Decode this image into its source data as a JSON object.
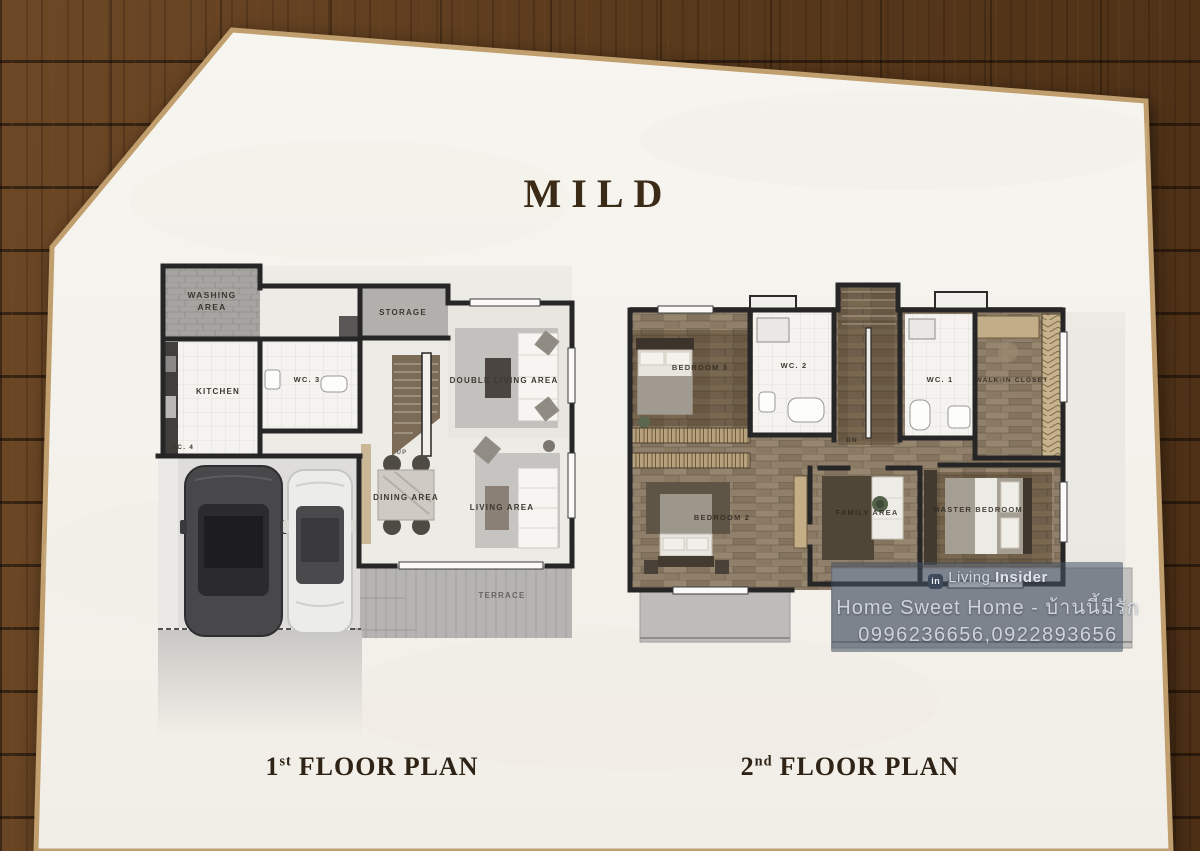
{
  "title": "MILD",
  "captions": {
    "first_num": "1",
    "first_sup": "st",
    "first_text": "FLOOR PLAN",
    "second_num": "2",
    "second_sup": "nd",
    "second_text": "FLOOR PLAN"
  },
  "floor1": {
    "washing1": "WASHING",
    "washing2": "AREA",
    "kitchen": "KITCHEN",
    "wc3": "WC. 3",
    "wc4": "WC. 4",
    "storage": "STORAGE",
    "up": "UP",
    "double_living": "DOUBLE LIVING AREA",
    "dining": "DINING AREA",
    "living": "LIVING AREA",
    "terrace": "TERRACE"
  },
  "floor2": {
    "bedroom3": "BEDROOM 3",
    "wc2": "WC. 2",
    "dn": "DN",
    "wc1": "WC. 1",
    "walkin": "WALK-IN CLOSET",
    "bedroom2": "BEDROOM 2",
    "family": "FAMILY AREA",
    "master": "MASTER BEDROOM"
  },
  "watermark": {
    "brand_prefix": "Living",
    "brand_suffix": "Insider",
    "logo_glyph": "in",
    "tagline": "Home Sweet Home - บ้านนี้มีรัก",
    "phones": "0996236656,0922893656"
  },
  "colors": {
    "wood_background": "#5e3c1d",
    "paper": "#f5f2ec",
    "paper_edge": "#c09e6d",
    "wall_ink": "#262626",
    "title_ink": "#3b2a16",
    "second_floor_wood": "#8d7d6b",
    "watermark_bg": "rgba(67,80,98,0.55)",
    "watermark_text": "#ccd3db"
  }
}
